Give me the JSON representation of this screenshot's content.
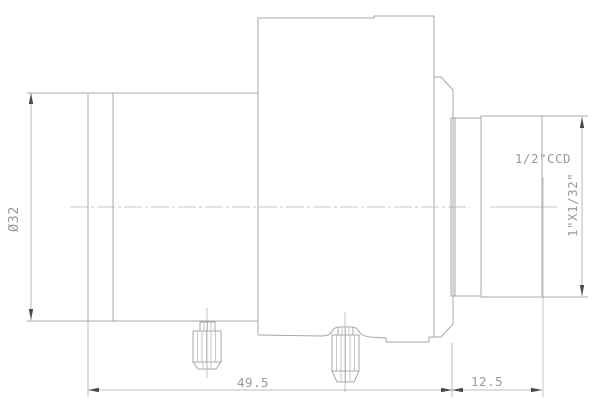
{
  "drawing": {
    "kind": "lens-mechanical-side-view",
    "dimensions": {
      "front_diameter": "Ø32",
      "body_length": "49.5",
      "mount_length": "12.5",
      "thread_spec": "1\"X1/32\"",
      "sensor_format": "1/2\"CCD"
    },
    "colors": {
      "background": "#ffffff",
      "outline": "#a8a8a8",
      "centerline": "#b6b6b6",
      "dimension_line": "#a9a9a9",
      "arrow": "#4a4a4a",
      "text": "#9a9a9a"
    }
  }
}
